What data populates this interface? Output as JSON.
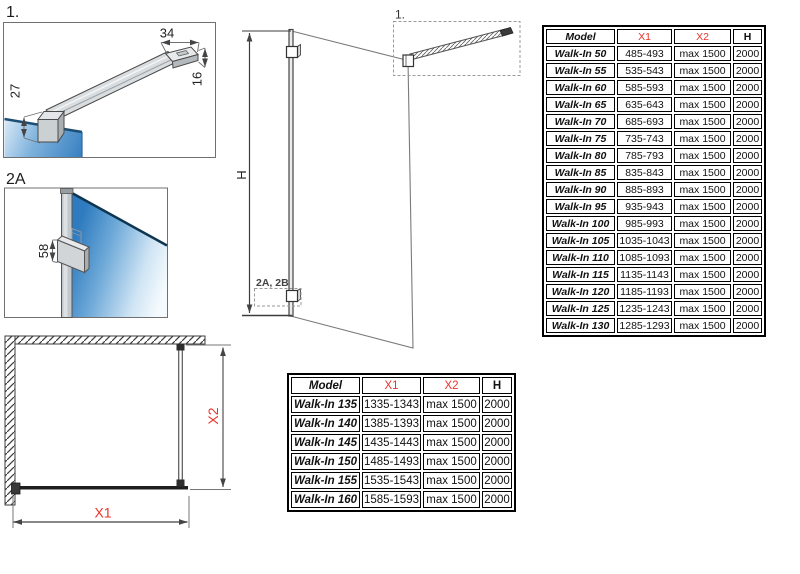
{
  "colors": {
    "accent_red": "#e8332c",
    "glass_blue": "#2e7bbf"
  },
  "figure1": {
    "label": "1.",
    "dim_bar_end_width": "34",
    "dim_bar_height": "16",
    "dim_clamp_height": "27"
  },
  "figure2a": {
    "label": "2A",
    "dim_bracket_height": "58"
  },
  "main_view": {
    "detail_callout_top": "1.",
    "detail_callout_bottom": "2A, 2B",
    "dim_height_label": "H"
  },
  "plan_view": {
    "dim_width_label": "X1",
    "dim_depth_label": "X2"
  },
  "table_large": {
    "headers": [
      {
        "label": "Model",
        "red": false
      },
      {
        "label": "X1",
        "red": true
      },
      {
        "label": "X2",
        "red": true
      },
      {
        "label": "H",
        "red": false
      }
    ],
    "rows": [
      [
        "Walk-In 50",
        "485-493",
        "max 1500",
        "2000"
      ],
      [
        "Walk-In 55",
        "535-543",
        "max 1500",
        "2000"
      ],
      [
        "Walk-In 60",
        "585-593",
        "max 1500",
        "2000"
      ],
      [
        "Walk-In 65",
        "635-643",
        "max 1500",
        "2000"
      ],
      [
        "Walk-In 70",
        "685-693",
        "max 1500",
        "2000"
      ],
      [
        "Walk-In 75",
        "735-743",
        "max 1500",
        "2000"
      ],
      [
        "Walk-In 80",
        "785-793",
        "max 1500",
        "2000"
      ],
      [
        "Walk-In 85",
        "835-843",
        "max 1500",
        "2000"
      ],
      [
        "Walk-In 90",
        "885-893",
        "max 1500",
        "2000"
      ],
      [
        "Walk-In 95",
        "935-943",
        "max 1500",
        "2000"
      ],
      [
        "Walk-In 100",
        "985-993",
        "max 1500",
        "2000"
      ],
      [
        "Walk-In 105",
        "1035-1043",
        "max 1500",
        "2000"
      ],
      [
        "Walk-In 110",
        "1085-1093",
        "max 1500",
        "2000"
      ],
      [
        "Walk-In 115",
        "1135-1143",
        "max 1500",
        "2000"
      ],
      [
        "Walk-In 120",
        "1185-1193",
        "max 1500",
        "2000"
      ],
      [
        "Walk-In 125",
        "1235-1243",
        "max 1500",
        "2000"
      ],
      [
        "Walk-In 130",
        "1285-1293",
        "max 1500",
        "2000"
      ]
    ]
  },
  "table_small": {
    "headers": [
      {
        "label": "Model",
        "red": false
      },
      {
        "label": "X1",
        "red": true
      },
      {
        "label": "X2",
        "red": true
      },
      {
        "label": "H",
        "red": false
      }
    ],
    "rows": [
      [
        "Walk-In 135",
        "1335-1343",
        "max 1500",
        "2000"
      ],
      [
        "Walk-In 140",
        "1385-1393",
        "max 1500",
        "2000"
      ],
      [
        "Walk-In 145",
        "1435-1443",
        "max 1500",
        "2000"
      ],
      [
        "Walk-In 150",
        "1485-1493",
        "max 1500",
        "2000"
      ],
      [
        "Walk-In 155",
        "1535-1543",
        "max 1500",
        "2000"
      ],
      [
        "Walk-In 160",
        "1585-1593",
        "max 1500",
        "2000"
      ]
    ]
  }
}
